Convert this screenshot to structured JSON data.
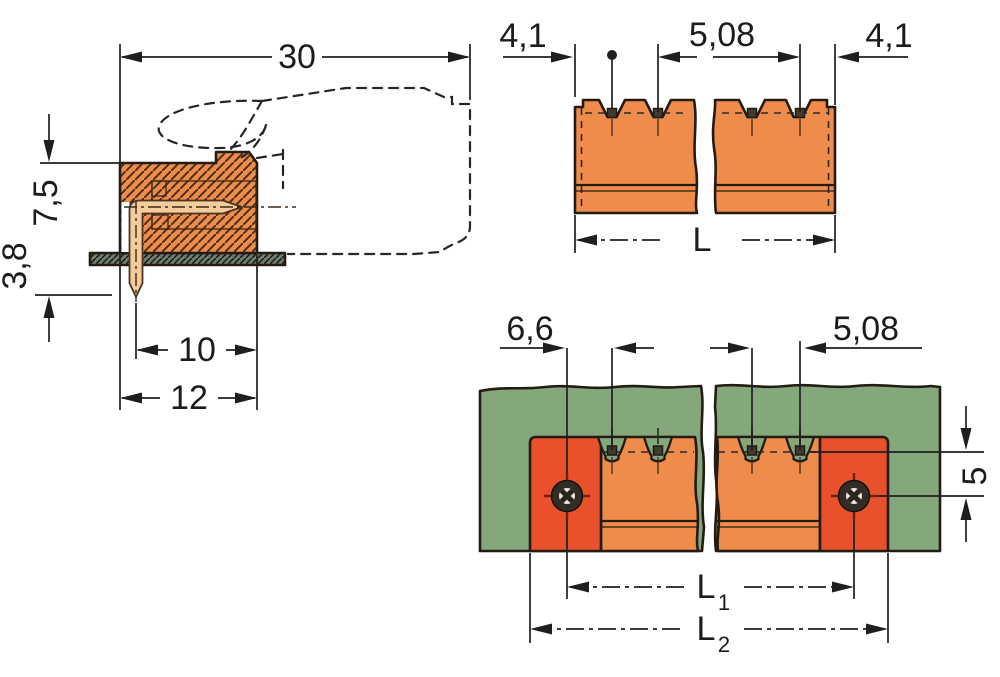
{
  "colors": {
    "body_orange": "#EF8C4B",
    "flange_red": "#E8512B",
    "pin_tan": "#F4CB9B",
    "pcb_green": "#84A77B",
    "pcb_strip_green": "#6E7E6D",
    "hatch_brown": "#4A3018",
    "outline": "#241C12"
  },
  "side_view": {
    "dim_total_depth": "30",
    "dim_height_above_board": "7,5",
    "dim_pin_below_board": "3,8",
    "dim_pin_to_front": "10",
    "dim_body_depth": "12"
  },
  "front_view": {
    "dim_end_margin_left": "4,1",
    "dim_pin_pitch": "5,08",
    "dim_end_margin_right": "4,1",
    "dim_total_length": "L"
  },
  "plan_view": {
    "dim_screw_to_pin": "6,6",
    "dim_pin_pitch": "5,08",
    "dim_pin_to_screw_axis": "5",
    "dim_l1": "L",
    "dim_l1_sub": "1",
    "dim_l2": "L",
    "dim_l2_sub": "2"
  }
}
